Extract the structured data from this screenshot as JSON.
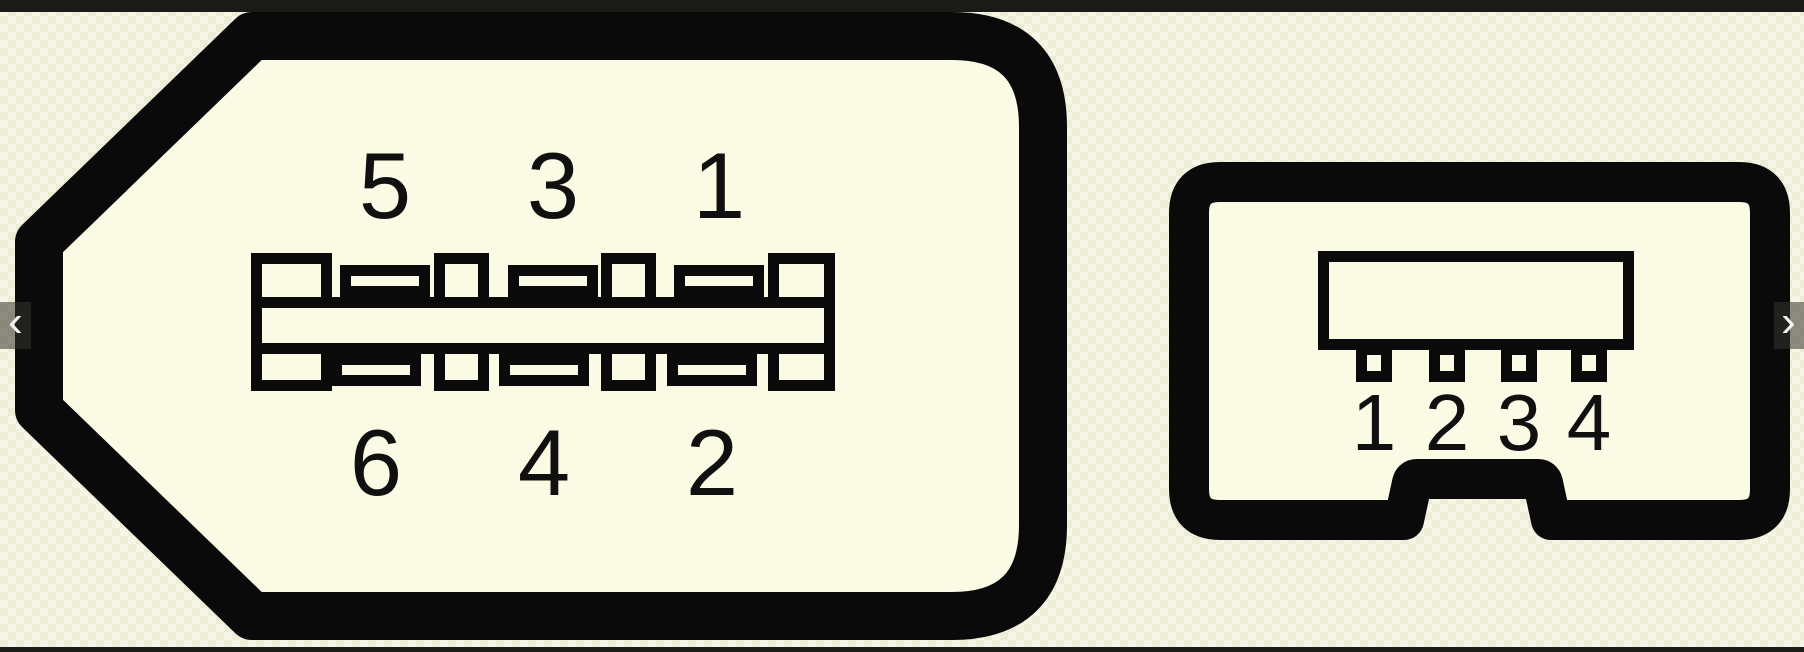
{
  "viewer": {
    "prev_button": "‹",
    "next_button": "›"
  },
  "left_connector": {
    "name": "FireWire 6-pin connector pinout",
    "top_pins": [
      "5",
      "3",
      "1"
    ],
    "bottom_pins": [
      "6",
      "4",
      "2"
    ]
  },
  "right_connector": {
    "name": "FireWire 4-pin connector pinout",
    "pins": [
      "1",
      "2",
      "3",
      "4"
    ]
  },
  "colors": {
    "background": "#f7f6e6",
    "background_check": "#edecd6",
    "connector_fill": "#fbfae5",
    "ink": "#0a0a0a",
    "edge_bar": "#1a1a16",
    "nav_overlay": "rgba(52,52,46,0.55)",
    "nav_glyph": "#f2f2ee"
  }
}
